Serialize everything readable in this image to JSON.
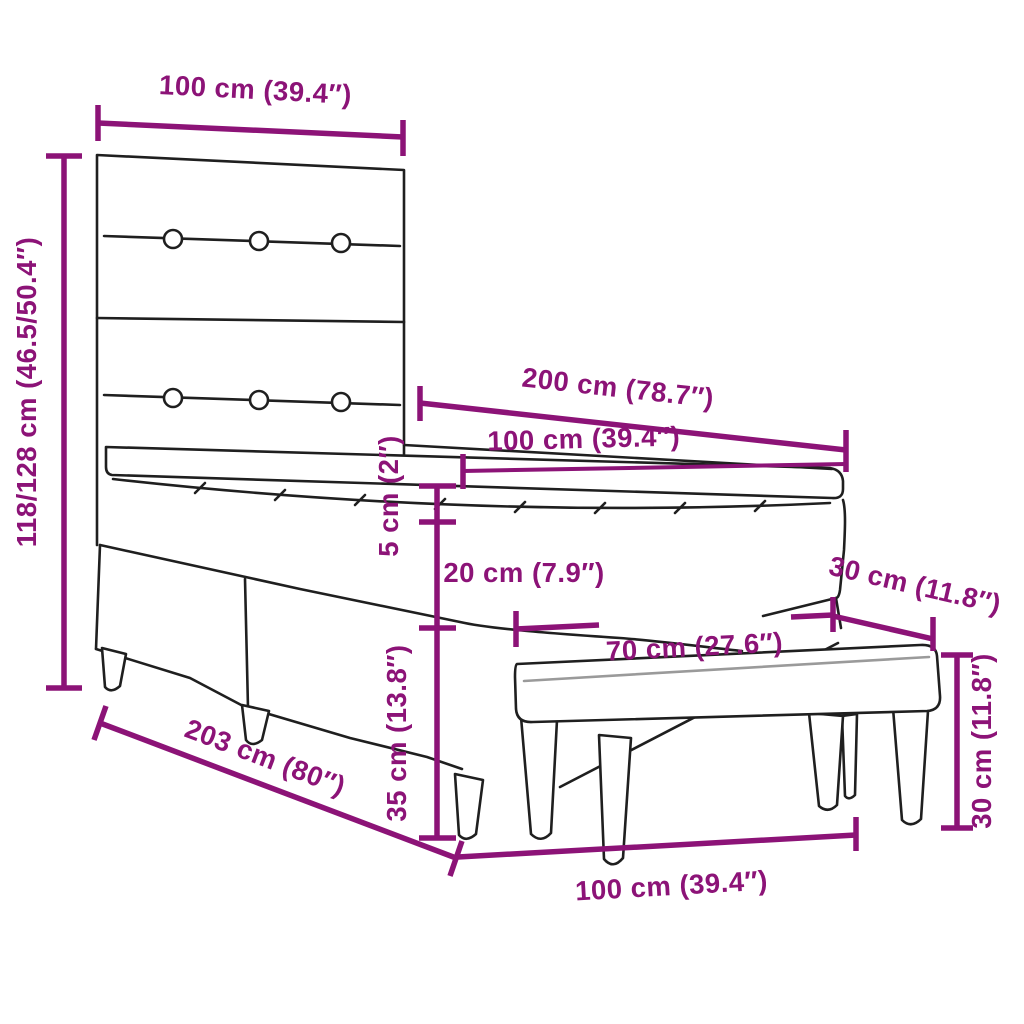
{
  "diagram": {
    "background": "#ffffff",
    "accent_color": "#8C1377",
    "line_color": "#1f1f1f",
    "labels": {
      "headboard_width": "100 cm (39.4″)",
      "total_height": "118/128 cm (46.5/50.4″)",
      "bed_length": "200 cm (78.7″)",
      "mattress_width": "100 cm (39.4″)",
      "topper_height": "5 cm (2″)",
      "mattress_height": "20 cm (7.9″)",
      "bench_depth": "30 cm (11.8″)",
      "bench_seat_length": "70 cm (27.6″)",
      "base_height": "35 cm (13.8″)",
      "bench_height": "30 cm (11.8″)",
      "bed_total_length": "203 cm (80″)",
      "bench_total_length": "100 cm (39.4″)"
    }
  }
}
